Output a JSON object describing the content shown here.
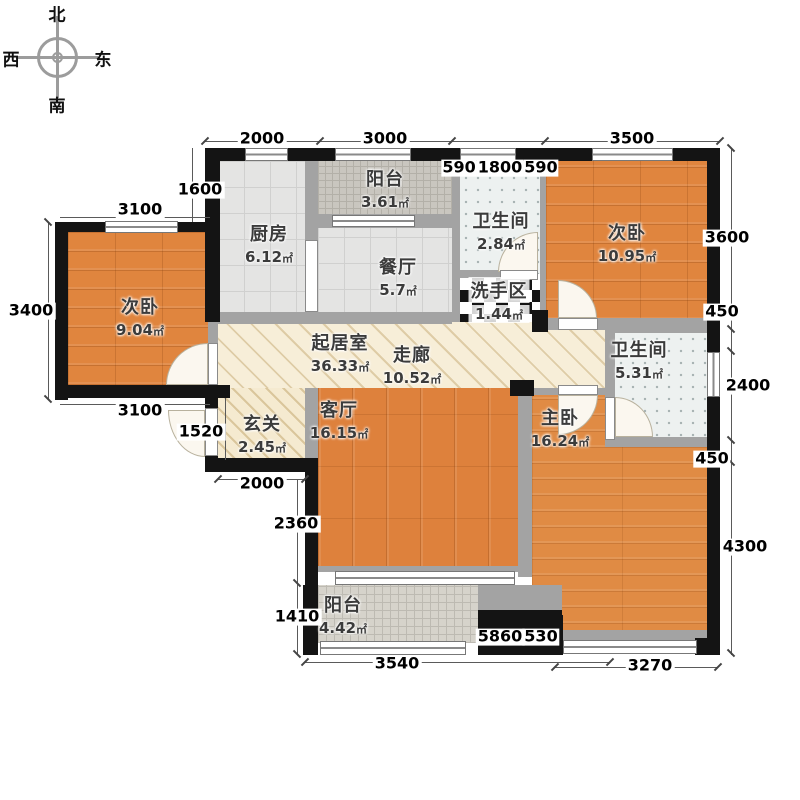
{
  "compass": {
    "north": "北",
    "south": "南",
    "west": "西",
    "east": "东"
  },
  "rooms": {
    "bedroom_left": {
      "name": "次卧",
      "area": "9.04",
      "unit": "㎡"
    },
    "kitchen": {
      "name": "厨房",
      "area": "6.12",
      "unit": "㎡"
    },
    "balcony_top": {
      "name": "阳台",
      "area": "3.61",
      "unit": "㎡"
    },
    "bath_top": {
      "name": "卫生间",
      "area": "2.84",
      "unit": "㎡"
    },
    "bedroom_top_right": {
      "name": "次卧",
      "area": "10.95",
      "unit": "㎡"
    },
    "dining": {
      "name": "餐厅",
      "area": "5.7",
      "unit": "㎡"
    },
    "wash_area": {
      "name": "洗手区",
      "area": "1.44",
      "unit": "㎡"
    },
    "living_main": {
      "name": "起居室",
      "area": "36.33",
      "unit": "㎡"
    },
    "corridor": {
      "name": "走廊",
      "area": "10.52",
      "unit": "㎡"
    },
    "bath_right": {
      "name": "卫生间",
      "area": "5.31",
      "unit": "㎡"
    },
    "foyer": {
      "name": "玄关",
      "area": "2.45",
      "unit": "㎡"
    },
    "living": {
      "name": "客厅",
      "area": "16.15",
      "unit": "㎡"
    },
    "master": {
      "name": "主卧",
      "area": "16.24",
      "unit": "㎡"
    },
    "balcony_bottom": {
      "name": "阳台",
      "area": "4.42",
      "unit": "㎡"
    }
  },
  "dims": {
    "d2000": "2000",
    "d3000": "3000",
    "d590a": "590",
    "d1800": "1800",
    "d590b": "590",
    "d3500": "3500",
    "d1600": "1600",
    "d3100t": "3100",
    "d3400": "3400",
    "d3100b": "3100",
    "d1520": "1520",
    "d2000f": "2000",
    "d2360": "2360",
    "d1410": "1410",
    "d3600": "3600",
    "d450t": "450",
    "d2400": "2400",
    "d450b": "450",
    "d4300": "4300",
    "d3540": "3540",
    "d5860": "5860",
    "d530": "530",
    "d3270": "3270"
  },
  "colors": {
    "wood": "#e0853e",
    "wall": "#141414",
    "inner_wall": "#a3a3a3",
    "corridor_fill": "#f7eed8",
    "tile": "#e4e4e3",
    "balcony_tile": "#c9c6bf",
    "bath_fill": "#edf1f0",
    "checker_dark": "#141414"
  }
}
